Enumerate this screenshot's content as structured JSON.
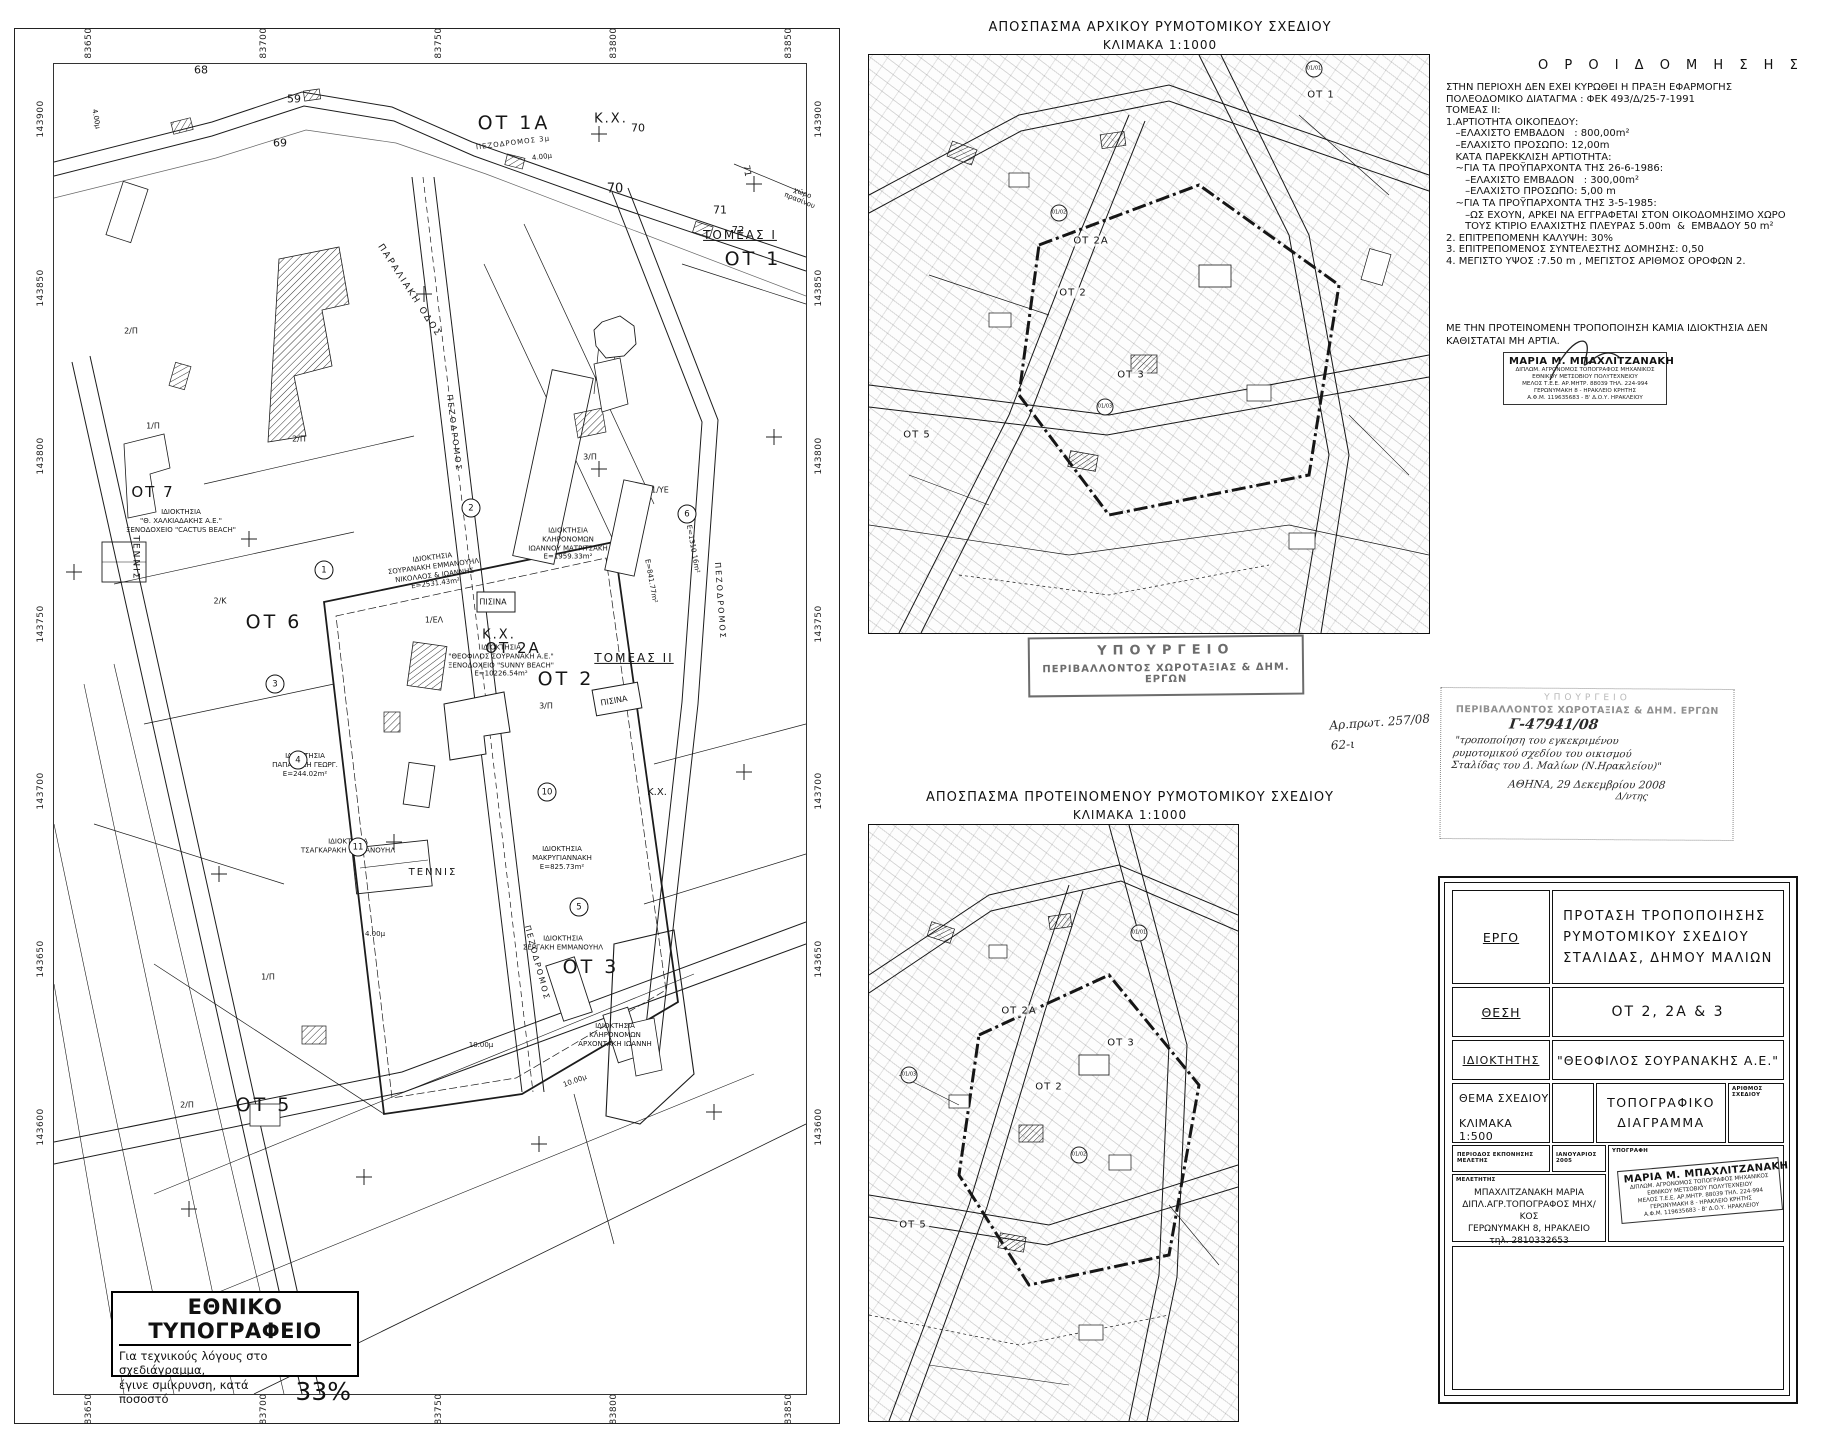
{
  "main_map": {
    "top_coords": [
      "83650",
      "83700",
      "83750",
      "83800",
      "83850"
    ],
    "bottom_coords": [
      "83650",
      "83700",
      "83750",
      "83800",
      "83850"
    ],
    "left_coords": [
      "143900",
      "143850",
      "143800",
      "143750",
      "143700",
      "143650",
      "143600"
    ],
    "right_coords": [
      "143900",
      "143850",
      "143800",
      "143750",
      "143700",
      "143650",
      "143600"
    ],
    "labels": {
      "ot1a": "ΟΤ 1Α",
      "ot1": "ΟΤ 1",
      "ot2": "ΟΤ 2",
      "ot2a": "ΟΤ 2Α",
      "ot3": "ΟΤ 3",
      "ot5": "ΟΤ 5",
      "ot6": "ΟΤ 6",
      "ot7": "ΟΤ 7",
      "tomeas1": "ΤΟΜΕΑΣ Ι",
      "tomeas2": "ΤΟΜΕΑΣ ΙΙ",
      "kx1": "Κ.Χ.",
      "kx2": "Κ.Χ.",
      "kx3": "Κ.Χ.",
      "n68": "68",
      "n59": "59",
      "n69": "69",
      "n70a": "70",
      "n70b": "70",
      "n71a": "71",
      "n71b": "71",
      "n72": "72",
      "paraliaki": "ΠΑΡΑΛΙΑΚΗ ΟΔΟΣ",
      "pez3m": "ΠΕΖΟΔΡΟΜΟΣ 3μ",
      "pez1": "ΠΕΖΟΔΡΟΜΟΣ",
      "pez2": "ΠΕΖΟΔΡΟΜΟΣ",
      "pez3": "ΠΕΖΟΔΡΟΜΟΣ",
      "tennis1": "ΤΕΝΝΙΣ",
      "tennis2": "ΤΕΝΝΙΣ",
      "pisina1": "ΠΙΣΙΝΑ",
      "pisina2": "ΠΙΣΙΝΑ",
      "xoros_prasinou": "χώρο πρασίνου",
      "p1": "ΙΔΙΟΚΤΗΣΙΑ\nΚΛΗΡΟΝΟΜΩΝ\nΙΩΑΝΝΟΥ ΜΑΤΡΙΤΣΑΚΗ\nΕ=1959.33m²",
      "p2": "ΙΔΙΟΚΤΗΣΙΑ\nΣΟΥΡΑΝΑΚΗ ΕΜΜΑΝΟΥΗΛ\nΝΙΚΟΛΑΟΣ & ΙΩΑΝΝΗΣ\nΕ=2531.43m²",
      "p3": "ΙΔΙΟΚΤΗΣΙΑ\n\"ΘΕΟΦΙΛΟΣ ΣΟΥΡΑΝΑΚΗ Α.Ε.\"\nΞΕΝΟΔΟΧΕΙΟ \"SUNNY BEACH\"\nΕ=10226.54m²",
      "p4": "ΙΔΙΟΚΤΗΣΙΑ\n\"Θ. ΧΑΛΚΙΑΔΑΚΗΣ Α.Ε.\"\nΞΕΝΟΔΟΧΕΙΟ \"CACTUS BEACH\"",
      "p5": "ΙΔΙΟΚΤΗΣΙΑ\nΠΑΠΑΔΑΚΗ ΓΕΩΡΓ.\nΕ=244.02m²",
      "p6": "ΙΔΙΟΚΤΗΣΙΑ\nΤΣΑΓΚΑΡΑΚΗ ΕΜΜΑΝΟΥΗΛ",
      "p7": "ΙΔΙΟΚΤΗΣΙΑ\nΜΑΚΡΥΓΙΑΝΝΑΚΗ\nΕ=825.73m²",
      "p8": "ΙΔΙΟΚΤΗΣΙΑ\nΣΕΡΓΑΚΗ ΕΜΜΑΝΟΥΗΛ",
      "p9": "ΙΔΙΟΚΤΗΣΙΑ\nΚΛΗΡΟΝΟΜΩΝ\nΑΡΧΟΝΤΑΚΗ ΙΩΑΝΝΗ",
      "e1": "Ε=841.77m²",
      "e2": "Ε=1310.16m²",
      "z1": "2/Π",
      "z2": "2/Π",
      "z3": "3/Π",
      "z4": "3/Π",
      "z5": "2/Π",
      "z6": "1/Π",
      "z7": "2/Κ",
      "z8": "1/ΕΛ",
      "z9": "1/ΥΕ",
      "z10": "1/Π",
      "m1": "4.00μ",
      "m2": "10.00μ",
      "m3": "10.00μ",
      "m4": "4.00μ",
      "m5": "4.00μ"
    },
    "circles": [
      "1",
      "2",
      "3",
      "4",
      "5",
      "6",
      "10",
      "11"
    ],
    "reduction_box": {
      "title": "ΕΘΝΙΚΟ ΤΥΠΟΓΡΑΦΕΙΟ",
      "line1": "Για τεχνικούς λόγους στο σχεδιάγραμμα,",
      "line2": "έγινε σμίκρυνση, κατά ποσοστό",
      "percent": "33%"
    }
  },
  "inset_original": {
    "title": "ΑΠΟΣΠΑΣΜΑ ΑΡΧΙΚΟΥ ΡΥΜΟΤΟΜΙΚΟΥ ΣΧΕΔΙΟΥ",
    "scale": "ΚΛΙΜΑΚΑ 1:1000",
    "labels": {
      "ot2a": "ΟΤ 2Α",
      "ot2": "ΟΤ 2",
      "ot3": "ΟΤ 3",
      "ot5": "ΟΤ 5",
      "ot1": "ΟΤ 1"
    },
    "circles": [
      "01/01",
      "01/02",
      "01/03"
    ]
  },
  "inset_proposed": {
    "title": "ΑΠΟΣΠΑΣΜΑ ΠΡΟΤΕΙΝΟΜΕΝΟΥ ΡΥΜΟΤΟΜΙΚΟΥ ΣΧΕΔΙΟΥ",
    "scale": "ΚΛΙΜΑΚΑ 1:1000",
    "labels": {
      "ot2a": "ΟΤ 2Α",
      "ot2": "ΟΤ 2",
      "ot3": "ΟΤ 3",
      "ot5": "ΟΤ 5"
    },
    "circles": [
      "01/01",
      "01/02",
      "01/03"
    ]
  },
  "ministry_stamp": {
    "line1": "ΥΠΟΥΡΓΕΙΟ",
    "line2": "ΠΕΡΙΒΑΛΛΟΝΤΟΣ ΧΩΡΟΤΑΞΙΑΣ & ΔΗΜ. ΕΡΓΩΝ"
  },
  "oroi": {
    "title": "Ο Ρ Ο Ι   Δ Ο Μ Η Σ Η Σ",
    "body": "ΣΤΗΝ ΠΕΡΙΟΧΗ ΔΕΝ ΕΧΕΙ ΚΥΡΩΘΕΙ Η ΠΡΑΞΗ ΕΦΑΡΜΟΓΗΣ\nΠΟΛΕΟΔΟΜΙΚΟ ΔΙΑΤΑΓΜΑ : ΦΕΚ 493/Δ/25-7-1991\nΤΟΜΕΑΣ ΙΙ:\n1.ΑΡΤΙΟΤΗΤΑ ΟΙΚΟΠΕΔΟΥ:\n   –ΕΛΑΧΙΣΤΟ ΕΜΒΑΔΟΝ   : 800,00m²\n   –ΕΛΑΧΙΣΤΟ ΠΡΟΣΩΠΟ: 12,00m\n   ΚΑΤΑ ΠΑΡΕΚΚΛΙΣΗ ΑΡΤΙΟΤΗΤΑ:\n   ~ΓΙΑ ΤΑ ΠΡΟΫΠΑΡΧΟΝΤΑ ΤΗΣ 26-6-1986:\n      –ΕΛΑΧΙΣΤΟ ΕΜΒΑΔΟΝ   : 300,00m²\n      –ΕΛΑΧΙΣΤΟ ΠΡΟΣΩΠΟ: 5,00 m\n   ~ΓΙΑ ΤΑ ΠΡΟΫΠΑΡΧΟΝΤΑ ΤΗΣ 3-5-1985:\n      –ΩΣ ΕΧΟΥΝ, ΑΡΚΕΙ ΝΑ ΕΓΓΡΑΦΕΤΑΙ ΣΤΟΝ ΟΙΚΟΔΟΜΗΣΙΜΟ ΧΩΡΟ\n      ΤΟΥΣ ΚΤΙΡΙΟ ΕΛΑΧΙΣΤΗΣ ΠΛΕΥΡΑΣ 5.00m  &  ΕΜΒΑΔΟΥ 50 m²\n2. ΕΠΙΤΡΕΠΟΜΕΝΗ ΚΑΛΥΨΗ: 30%\n3. ΕΠΙΤΡΕΠΟΜΕΝΟΣ ΣΥΝΤΕΛΕΣΤΗΣ ΔΟΜΗΣΗΣ: 0,50\n4. ΜΕΓΙΣΤΟ ΥΨΟΣ :7.50 m , ΜΕΓΙΣΤΟΣ ΑΡΙΘΜΟΣ ΟΡΟΦΩΝ 2.",
    "note": "ΜΕ ΤΗΝ ΠΡΟΤΕΙΝΟΜΕΝΗ ΤΡΟΠΟΠΟΙΗΣΗ ΚΑΜΙΑ ΙΔΙΟΚΤΗΣΙΑ ΔΕΝ\nΚΑΘΙΣΤΑΤΑΙ ΜΗ ΑΡΤΙΑ.",
    "engineer_heading": "Ο  ΜΗΧΑΝΙΚΟΣ"
  },
  "engineer_stamp": {
    "name": "ΜΑΡΙΑ Μ. ΜΠΑΧΛΙΤΖΑΝΑΚΗ",
    "line2": "ΔΙΠΛΩΜ. ΑΓΡΟΝΟΜΟΣ ΤΟΠΟΓΡΑΦΟΣ ΜΗΧΑΝΙΚΟΣ",
    "line3": "ΕΘΝΙΚΟΥ ΜΕΤΣΟΒΙΟΥ ΠΟΛΥΤΕΧΝΕΙΟΥ",
    "line4": "ΜΕΛΟΣ Τ.Ε.Ε. ΑΡ.ΜΗΤΡ. 88039 ΤΗΛ. 224-994",
    "line5": "ΓΕΡΩΝΥΜΑΚΗ 8 - ΗΡΑΚΛΕΙΟ ΚΡΗΤΗΣ",
    "line6": "Α.Φ.Μ. 119635683 - Β' Δ.Ο.Υ. ΗΡΑΚΛΕΙΟΥ"
  },
  "approval_stamp": {
    "ministry_faint": "ΥΠΟΥΡΓΕΙΟ",
    "dept": "ΠΕΡΙΒΑΛΛΟΝΤΟΣ ΧΩΡΟΤΑΞΙΑΣ & ΔΗΜ. ΕΡΓΩΝ",
    "protocol_number": "Γ-47941/08",
    "subject": "\"τροποποίηση του εγκεκριμένου\nρυμοτομικού σχεδίου του οικισμού\nΣταλίδας του Δ. Μαλίων (Ν.Ηρακλείου)\"",
    "place_date": "ΑΘΗΝΑ, 29 Δεκεμβρίου 2008",
    "signature": "Δ/ντης"
  },
  "margin_note": {
    "text": "Αρ.πρωτ. 257/08\n        62-ι"
  },
  "title_block": {
    "ergo_label": "ΕΡΓΟ",
    "ergo_value": "ΠΡΟΤΑΣΗ ΤΡΟΠΟΠΟΙΗΣΗΣ\nΡΥΜΟΤΟΜΙΚΟΥ ΣΧΕΔΙΟΥ\nΣΤΑΛΙΔΑΣ, ΔΗΜΟΥ ΜΑΛΙΩΝ",
    "thesi_label": "ΘΕΣΗ",
    "thesi_value": "ΟΤ 2, 2Α & 3",
    "idioktitis_label": "ΙΔΙΟΚΤΗΤΗΣ",
    "idioktitis_value": "\"ΘΕΟΦΙΛΟΣ ΣΟΥΡΑΝΑΚΗΣ Α.Ε.\"",
    "thema_label": "ΘΕΜΑ ΣΧΕΔΙΟΥ",
    "klimaka": "ΚΛΙΜΑΚΑ   1:500",
    "drawing_type": "ΤΟΠΟΓΡΑΦΙΚΟ\nΔΙΑΓΡΑΜΜΑ",
    "arithmos_label": "ΑΡΙΘΜΟΣ ΣΧΕΔΙΟΥ",
    "period_label": "ΠΕΡΙΟΔΟΣ ΕΚΠΟΝΗΣΗΣ ΜΕΛΕΤΗΣ",
    "period_value": "ΙΑΝΟΥΑΡΙΟΣ 2005",
    "ypografi_label": "ΥΠΟΓΡΑΦΗ",
    "meletitis_label": "ΜΕΛΕΤΗΤΗΣ",
    "meletitis_value": "ΜΠΑΧΛΙΤΖΑΝΑΚΗ ΜΑΡΙΑ\nΔΙΠΛ.ΑΓΡ.ΤΟΠΟΓΡΑΦΟΣ ΜΗΧ/ΚΟΣ\nΓΕΡΩΝΥΜΑΚΗ 8, ΗΡΑΚΛΕΙΟ\nτηλ. 2810332653"
  }
}
